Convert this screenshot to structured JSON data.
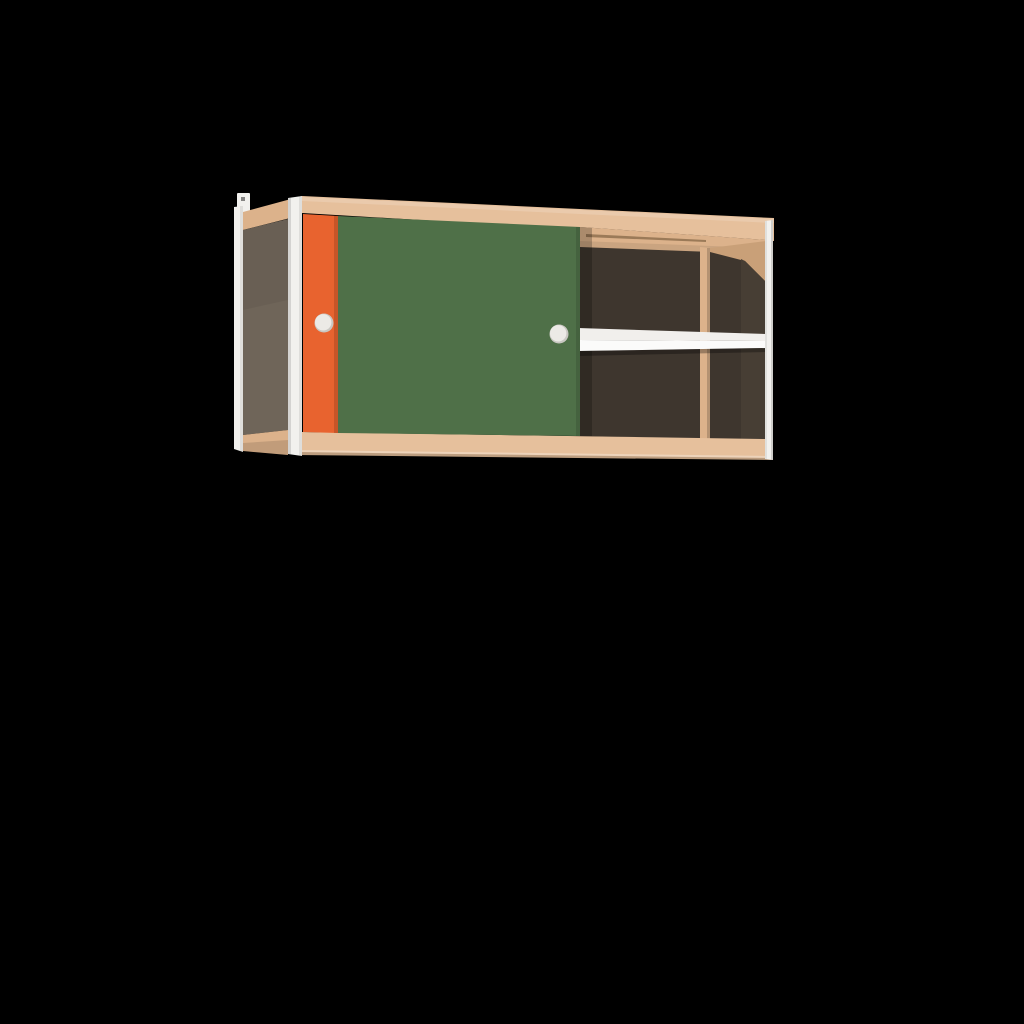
{
  "meta": {
    "type": "3d-product-render",
    "subject": "Wall-mounted cabinet with two sliding doors (orange and green) and an open compartment with a shelf",
    "background_color": "#000000",
    "canvas": {
      "width": 1024,
      "height": 1024
    }
  },
  "colors": {
    "background": "#000000",
    "wood": "#e6c09c",
    "wood_mid": "#dcb28b",
    "wood_shade": "#c9a078",
    "wood_dark": "#9b7a58",
    "panel_gray": "#6f6559",
    "interior_dark": "#3e362e",
    "interior_dark_warm": "#473e34",
    "door_orange": "#e8632f",
    "door_green": "#4f7048",
    "frame_white": "#f2f1ee",
    "shelf_top": "#f1efec",
    "shelf_front": "#fbfbfa",
    "handle": "#eceae6",
    "handle_shade": "#c9c7c2"
  },
  "parts": {
    "cabinet": "Wall cabinet with sliding doors",
    "wall_bracket": "Wall-mount bracket",
    "rear_left_post": "Rear left frame post",
    "front_left_post": "Front left frame post",
    "front_right_post": "Front right frame post",
    "left_side_panel": "Left side panel",
    "top_rail": "Top rail",
    "bottom_rail": "Bottom rail",
    "orange_door": "Orange sliding door",
    "green_door": "Green sliding door",
    "orange_door_handle": "Orange door handle",
    "green_door_handle": "Green door handle",
    "interior": "Open compartment interior",
    "track": "Sliding door track",
    "divider": "Interior divider",
    "right_side_panel": "Right side panel interior",
    "shelf": "Shelf"
  }
}
